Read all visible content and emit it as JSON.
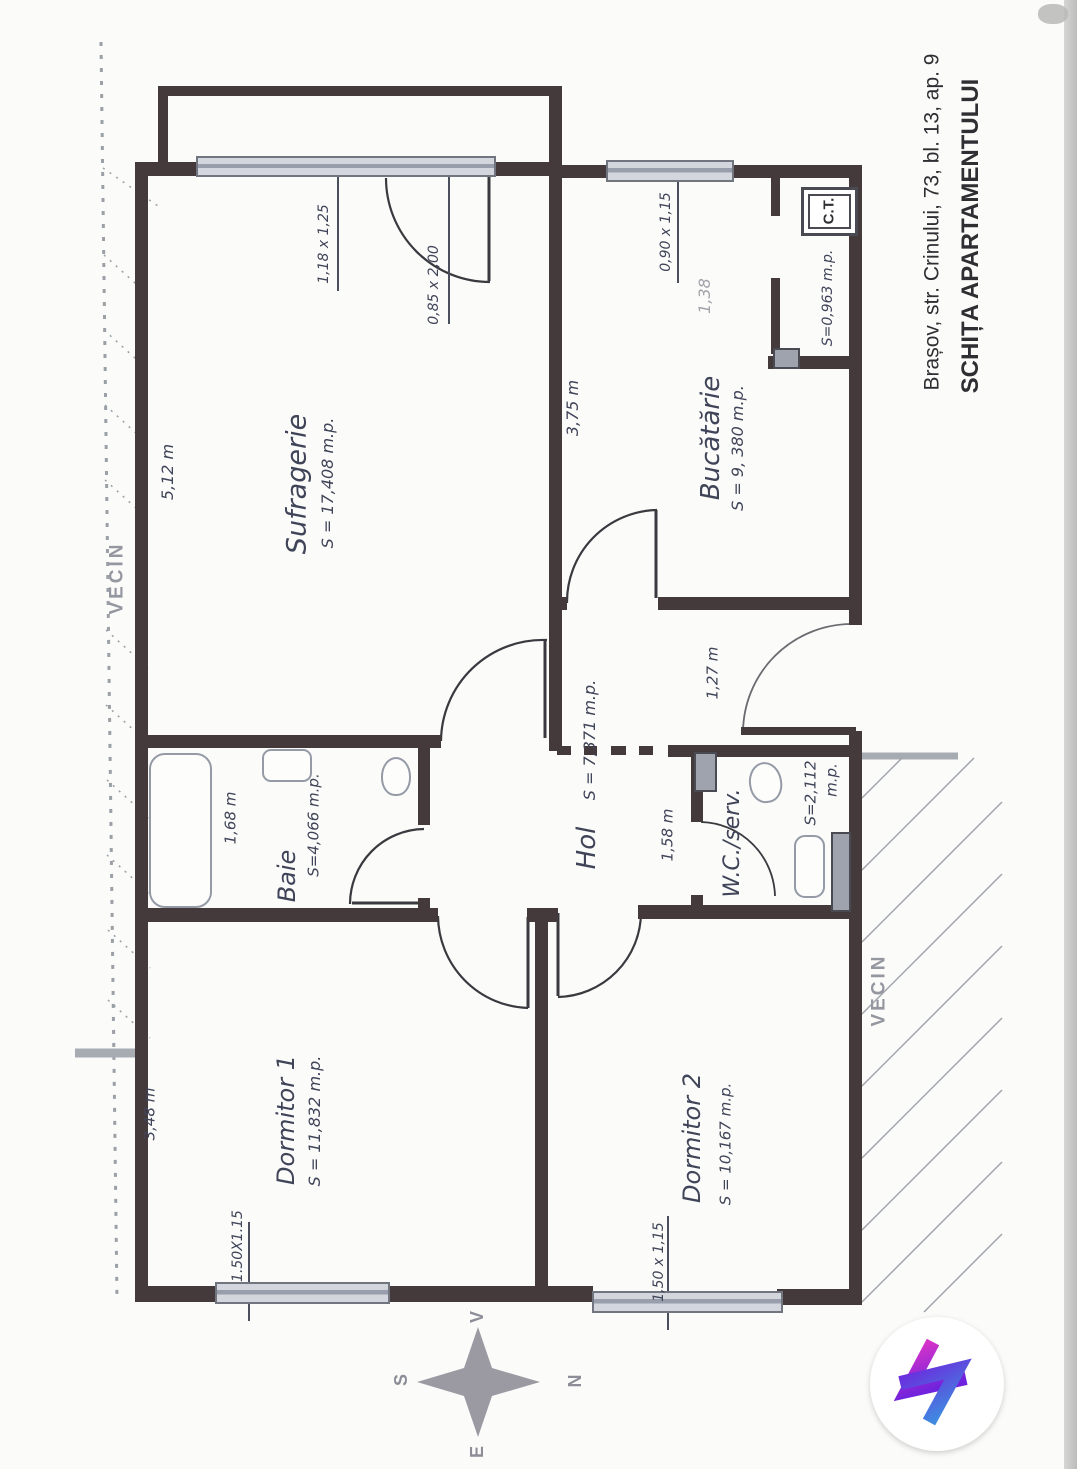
{
  "page": {
    "title_address": "Brașov, str. Crinului, 73, bl. 13, ap. 9",
    "title_main": "SCHIȚA APARTAMENTULUI"
  },
  "rooms": {
    "sufragerie": {
      "name": "Sufragerie",
      "area": "S = 17,408 m.p.",
      "width": "5,12 m"
    },
    "bucatarie": {
      "name": "Bucătărie",
      "area": "S = 9, 380 m.p.",
      "width": "3,75 m"
    },
    "hol": {
      "name": "Hol",
      "area": "S = 7,371 m.p.",
      "width": "1,58 m",
      "corridor_width": "1,27 m"
    },
    "baie": {
      "name": "Baie",
      "area": "S=4,066 m.p.",
      "width": "1,68 m"
    },
    "wc": {
      "name": "W.C./serv.",
      "area": "S=2,112",
      "area_unit": "m.p."
    },
    "dormitor1": {
      "name": "Dormitor 1",
      "area": "S = 11,832 m.p.",
      "width": "3,48 m"
    },
    "dormitor2": {
      "name": "Dormitor 2",
      "area": "S = 10,167 m.p."
    },
    "centrala": {
      "label": "C.T.",
      "area": "S=0,963 m.p.",
      "width": "1,38"
    }
  },
  "windows": {
    "sufragerie": "1,18 x 1,25",
    "balcony_door": "0,85 x 2,00",
    "bucatarie": "0,90 x 1,15",
    "dormitor1": "1.50X1.15",
    "dormitor2": "1,50 x 1,15"
  },
  "neighbors": {
    "left": "VECIN",
    "right": "VECIN"
  },
  "compass": {
    "top": "V",
    "left": "S",
    "right": "N",
    "bottom": "E"
  },
  "colors": {
    "wall": "#443a3c",
    "ink": "#3f4458",
    "muted_gray": "#a2a2aa",
    "window_fill": "#cdd0d8",
    "hatch": "#9aa0a6",
    "logo_pink": "#e335c6",
    "logo_purple": "#6f22dd",
    "logo_blue": "#3f8be0"
  }
}
